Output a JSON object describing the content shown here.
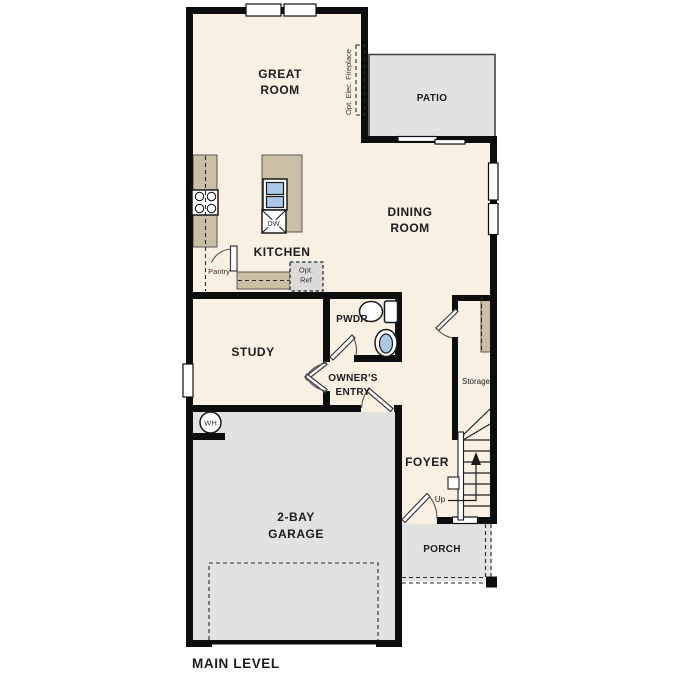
{
  "plan_title": "MAIN LEVEL",
  "rooms": {
    "great_room": {
      "line1": "GREAT",
      "line2": "ROOM"
    },
    "patio": {
      "label": "PATIO"
    },
    "dining_room": {
      "line1": "DINING",
      "line2": "ROOM"
    },
    "kitchen": {
      "label": "KITCHEN"
    },
    "study": {
      "label": "STUDY"
    },
    "powder": {
      "label": "PWDR"
    },
    "owners_entry": {
      "line1": "OWNER'S",
      "line2": "ENTRY"
    },
    "foyer": {
      "label": "FOYER"
    },
    "garage": {
      "line1": "2-BAY",
      "line2": "GARAGE"
    },
    "porch": {
      "label": "PORCH"
    },
    "storage": {
      "label": "Storage"
    }
  },
  "annotations": {
    "pantry": "Pantry",
    "opt_ref": {
      "line1": "Opt.",
      "line2": "Ref"
    },
    "opt_elec_fireplace": "Opt. Elec. Fireplace",
    "dishwasher": "DW",
    "water_heater": "WH",
    "stairs_up": "Up"
  },
  "colors": {
    "wall": "#0d0d0d",
    "floor": "#f7f0e3",
    "outdoor": "#e2e2e0",
    "counter": "#cabea5",
    "sink-blue": "#abc8e6",
    "text": "#1c1c1c"
  }
}
